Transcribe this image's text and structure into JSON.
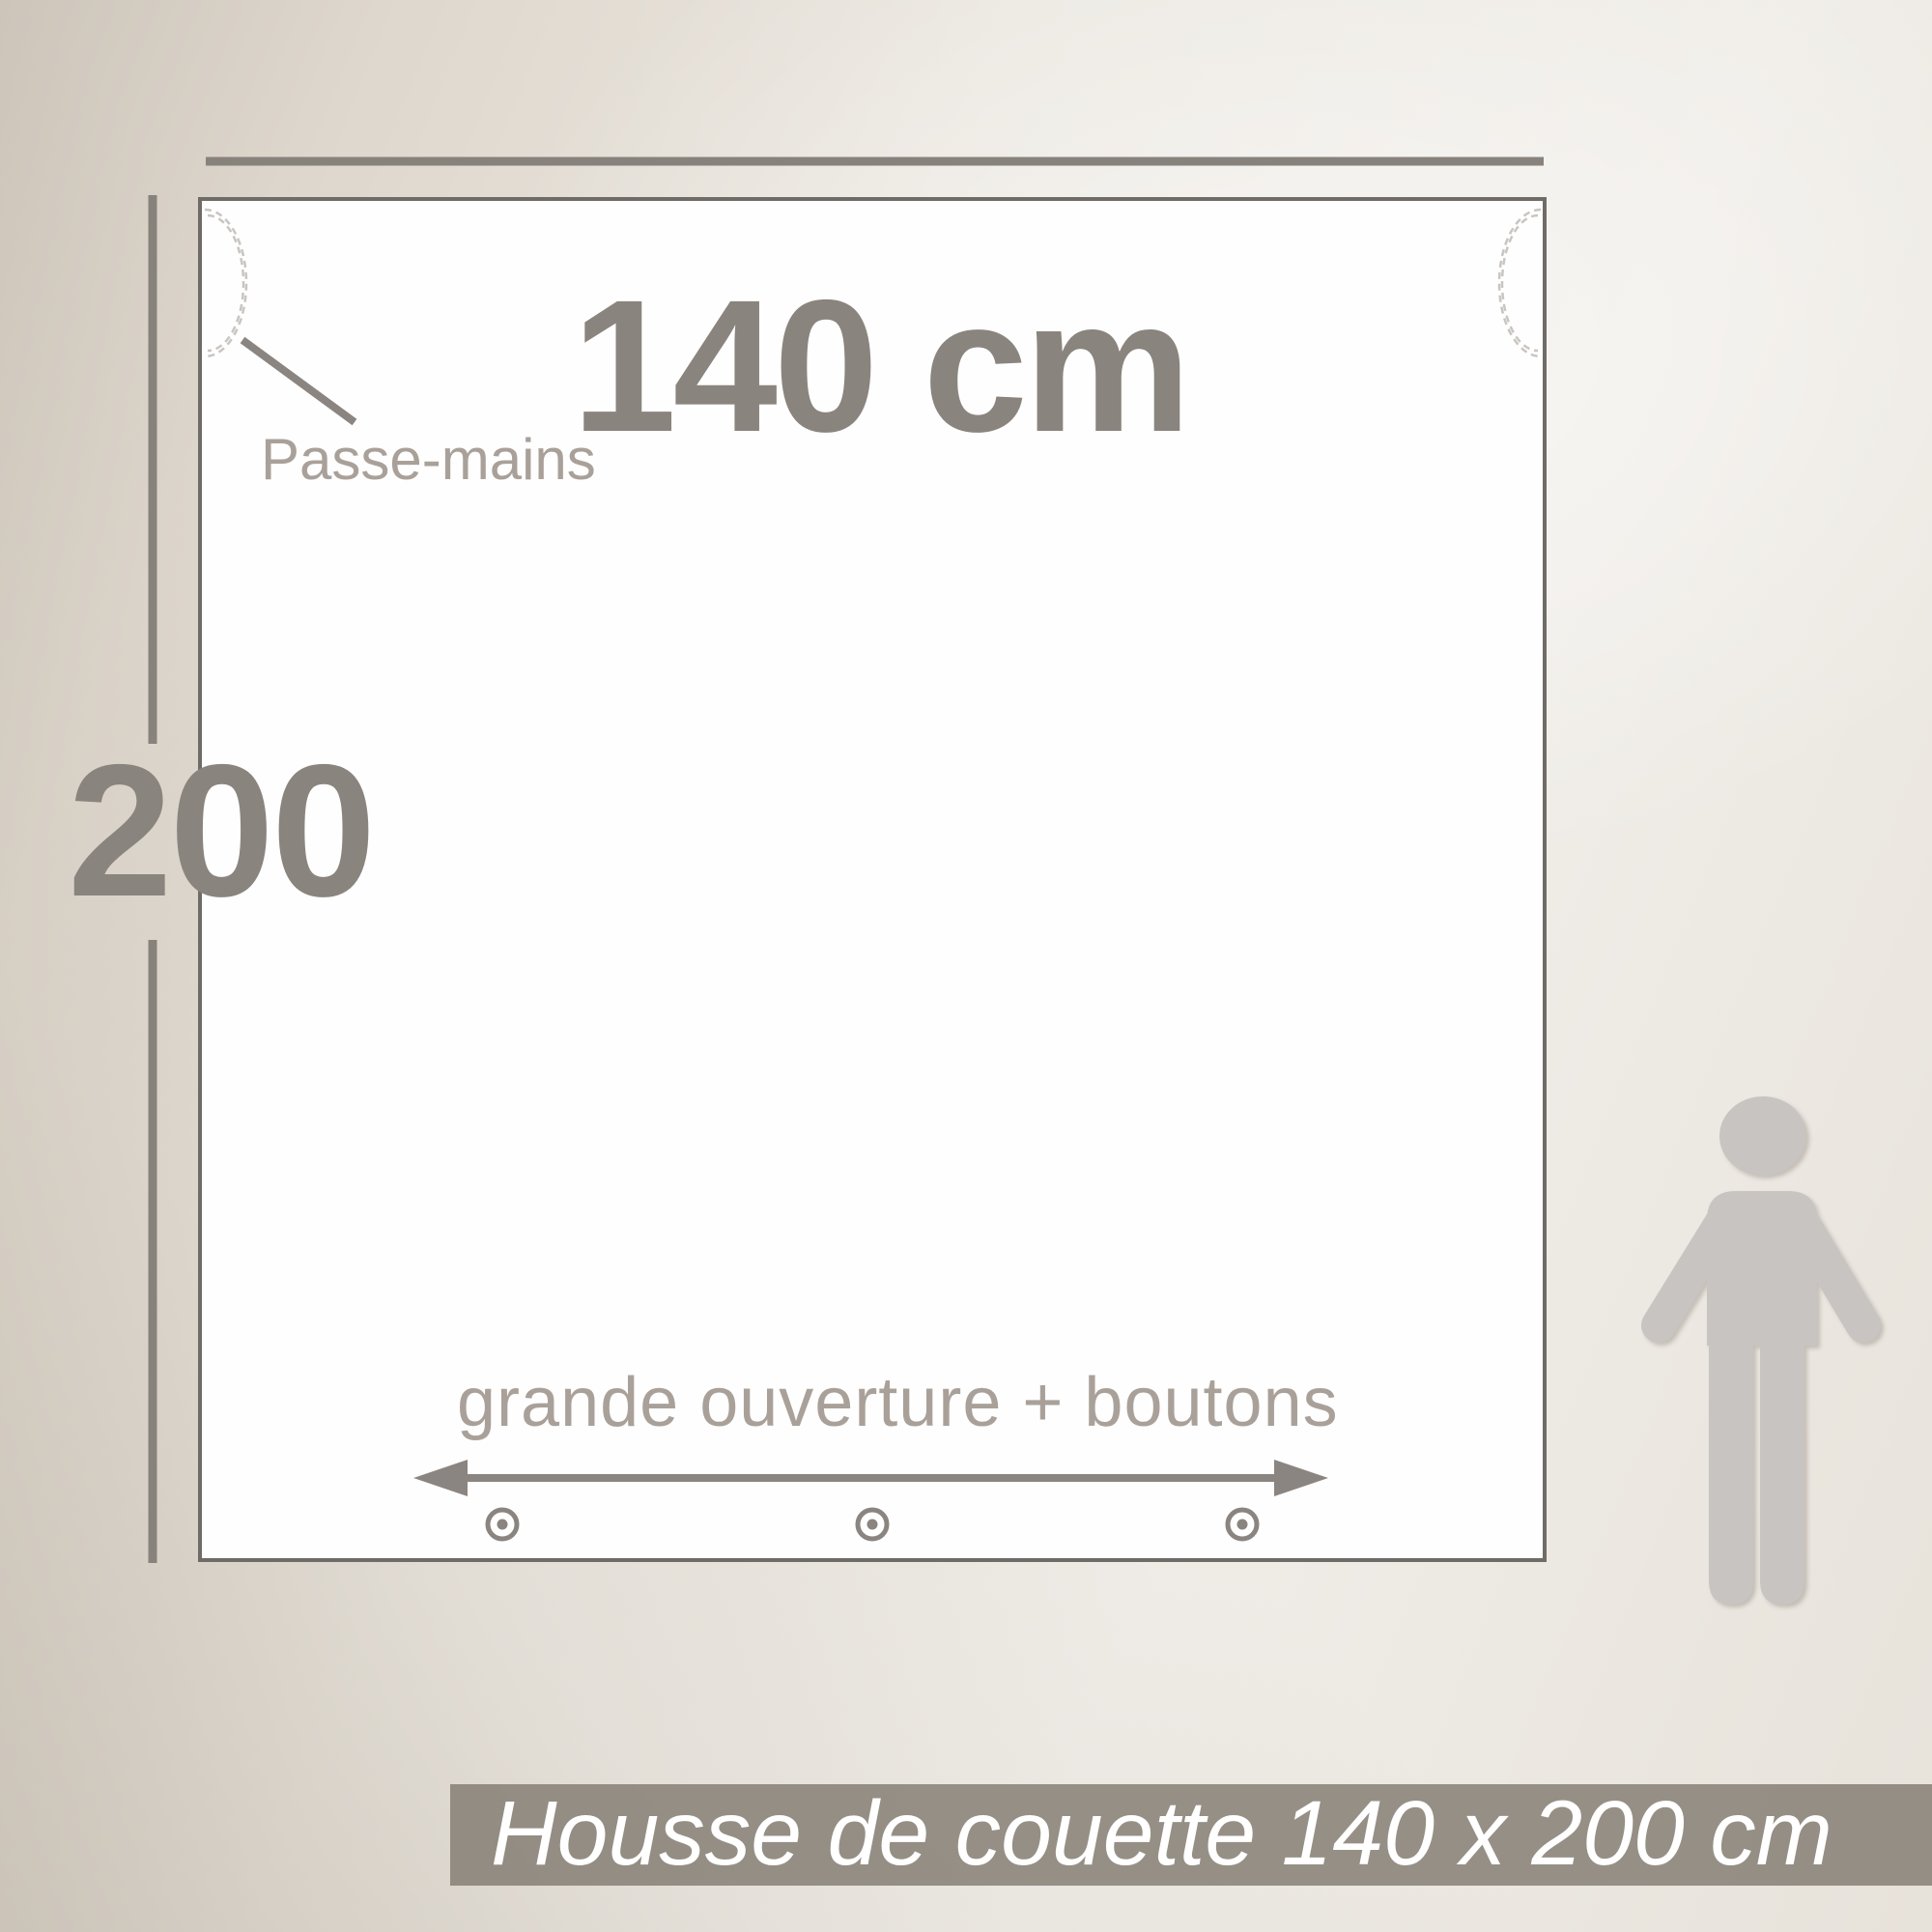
{
  "product_diagram": {
    "width_label": "140 cm",
    "height_label": "200",
    "hand_hole_label": "Passe-mains",
    "opening_label": "grande ouverture + boutons",
    "hand_hole_count": 2,
    "button_count": 3
  },
  "banner": {
    "text": "Housse de couette 140 x 200 cm",
    "bg_color": "#827a72",
    "text_color": "#ffffff"
  },
  "icons": {
    "person": "person-silhouette-icon",
    "button": "button-stud-icon",
    "opening_arrow": "double-headed-arrow-icon",
    "hand_hole": "stitched-hand-hole-arc-icon"
  },
  "colors": {
    "dimension_line": "#88827c",
    "large_label_text": "#8a847e",
    "small_label_text": "#a9a199",
    "square_border": "#6f6b66",
    "square_fill": "#fefefe",
    "stitch_dash": "#c9c5c0",
    "person_fill": "#c7c4c1",
    "background_light": "#f2efeb",
    "background_dark": "#c2bab0"
  }
}
